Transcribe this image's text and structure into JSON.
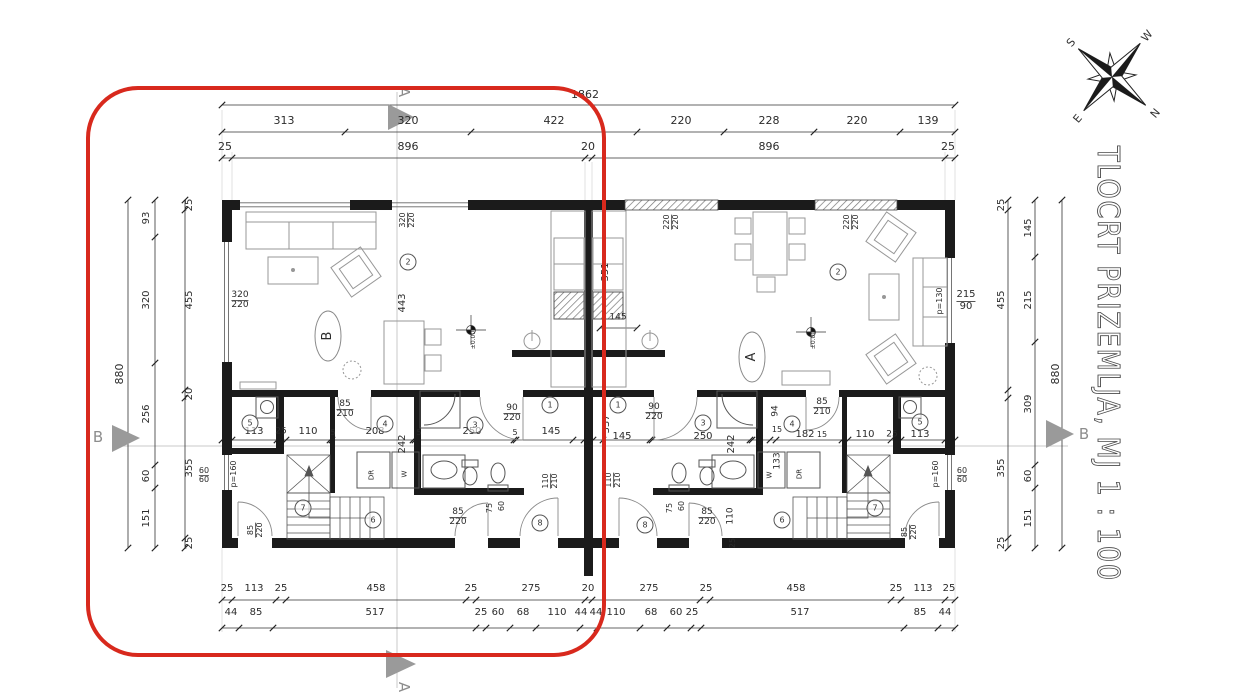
{
  "title": {
    "text": "TLOCRT PRIZEMLJA, MJ 1 : 100"
  },
  "compass": {
    "s": "S",
    "w": "W",
    "e": "E",
    "n": "N"
  },
  "section_markers": {
    "top": "A",
    "bottom": "A",
    "left": "B",
    "right": "B"
  },
  "units": {
    "left_oval_label": "B",
    "right_oval_label": "A"
  },
  "highlight_color": "#d8291d",
  "dimension_chains": {
    "top": {
      "total": "1862",
      "mid": [
        "313",
        "320",
        "422",
        "220",
        "228",
        "220",
        "139"
      ],
      "inner": [
        "25",
        "896",
        "20",
        "896",
        "25"
      ]
    },
    "left": {
      "total": "880",
      "mid": [
        "93",
        "320",
        "256",
        "60",
        "151"
      ],
      "inner": [
        "25",
        "455",
        "20",
        "355",
        "25"
      ]
    },
    "right": {
      "total": "880",
      "mid": [
        "145",
        "215",
        "309",
        "60",
        "151"
      ],
      "inner": [
        "25",
        "455",
        "355",
        "25"
      ]
    },
    "bottom": {
      "outer": [
        "25",
        "113",
        "25",
        "458",
        "25",
        "275",
        "20",
        "275",
        "25",
        "458",
        "25",
        "113",
        "25"
      ],
      "inner": [
        "44",
        "85",
        "517",
        "25",
        "60",
        "68",
        "110",
        "44",
        "44",
        "110",
        "68",
        "60",
        "25",
        "517",
        "85",
        "44"
      ]
    }
  },
  "room_numbers": [
    [
      408,
      262,
      "2"
    ],
    [
      550,
      405,
      "1"
    ],
    [
      475,
      425,
      "3"
    ],
    [
      385,
      424,
      "4"
    ],
    [
      250,
      423,
      "5"
    ],
    [
      373,
      520,
      "6"
    ],
    [
      303,
      508,
      "7"
    ],
    [
      540,
      523,
      "8"
    ],
    [
      838,
      272,
      "2"
    ],
    [
      618,
      405,
      "1"
    ],
    [
      703,
      423,
      "3"
    ],
    [
      792,
      424,
      "4"
    ],
    [
      920,
      422,
      "5"
    ],
    [
      782,
      520,
      "6"
    ],
    [
      875,
      508,
      "7"
    ],
    [
      645,
      525,
      "8"
    ]
  ],
  "plan_labels": [
    [
      585,
      95,
      "1862",
      0,
      11
    ],
    [
      284,
      121,
      "313",
      0,
      11
    ],
    [
      408,
      121,
      "320",
      0,
      11
    ],
    [
      554,
      121,
      "422",
      0,
      11
    ],
    [
      681,
      121,
      "220",
      0,
      11
    ],
    [
      769,
      121,
      "228",
      0,
      11
    ],
    [
      857,
      121,
      "220",
      0,
      11
    ],
    [
      928,
      121,
      "139",
      0,
      11
    ],
    [
      225,
      147,
      "25",
      0,
      11
    ],
    [
      408,
      147,
      "896",
      0,
      11
    ],
    [
      588,
      147,
      "20",
      0,
      11
    ],
    [
      769,
      147,
      "896",
      0,
      11
    ],
    [
      948,
      147,
      "25",
      0,
      11
    ],
    [
      227,
      589,
      "25",
      0,
      10
    ],
    [
      254,
      589,
      "113",
      0,
      10
    ],
    [
      281,
      589,
      "25",
      0,
      10
    ],
    [
      376,
      589,
      "458",
      0,
      10
    ],
    [
      471,
      589,
      "25",
      0,
      10
    ],
    [
      531,
      589,
      "275",
      0,
      10
    ],
    [
      588,
      589,
      "20",
      0,
      10
    ],
    [
      649,
      589,
      "275",
      0,
      10
    ],
    [
      706,
      589,
      "25",
      0,
      10
    ],
    [
      796,
      589,
      "458",
      0,
      10
    ],
    [
      896,
      589,
      "25",
      0,
      10
    ],
    [
      923,
      589,
      "113",
      0,
      10
    ],
    [
      949,
      589,
      "25",
      0,
      10
    ],
    [
      231,
      613,
      "44",
      0,
      10
    ],
    [
      256,
      613,
      "85",
      0,
      10
    ],
    [
      375,
      613,
      "517",
      0,
      10
    ],
    [
      481,
      613,
      "25",
      0,
      10
    ],
    [
      498,
      613,
      "60",
      0,
      10
    ],
    [
      523,
      613,
      "68",
      0,
      10
    ],
    [
      557,
      613,
      "110",
      0,
      10
    ],
    [
      581,
      613,
      "44",
      0,
      10
    ],
    [
      596,
      613,
      "44",
      0,
      10
    ],
    [
      616,
      613,
      "110",
      0,
      10
    ],
    [
      651,
      613,
      "68",
      0,
      10
    ],
    [
      676,
      613,
      "60",
      0,
      10
    ],
    [
      692,
      613,
      "25",
      0,
      10
    ],
    [
      800,
      613,
      "517",
      0,
      10
    ],
    [
      920,
      613,
      "85",
      0,
      10
    ],
    [
      945,
      613,
      "44",
      0,
      10
    ],
    [
      120,
      374,
      "880",
      -90,
      11
    ],
    [
      147,
      218,
      "93",
      -90,
      10
    ],
    [
      147,
      300,
      "320",
      -90,
      10
    ],
    [
      147,
      414,
      "256",
      -90,
      10
    ],
    [
      147,
      476,
      "60",
      -90,
      10
    ],
    [
      147,
      518,
      "151",
      -90,
      10
    ],
    [
      190,
      205,
      "25",
      -90,
      10
    ],
    [
      190,
      300,
      "455",
      -90,
      10
    ],
    [
      190,
      394,
      "20",
      -90,
      10
    ],
    [
      190,
      468,
      "355",
      -90,
      10
    ],
    [
      190,
      543,
      "25",
      -90,
      10
    ],
    [
      204,
      476,
      "60|60",
      0,
      8
    ],
    [
      1002,
      205,
      "25",
      -90,
      10
    ],
    [
      1002,
      300,
      "455",
      -90,
      10
    ],
    [
      1002,
      468,
      "355",
      -90,
      10
    ],
    [
      1002,
      543,
      "25",
      -90,
      10
    ],
    [
      1029,
      228,
      "145",
      -90,
      10
    ],
    [
      1029,
      300,
      "215",
      -90,
      10
    ],
    [
      1029,
      404,
      "309",
      -90,
      10
    ],
    [
      1029,
      476,
      "60",
      -90,
      10
    ],
    [
      1029,
      518,
      "151",
      -90,
      10
    ],
    [
      1056,
      374,
      "880",
      -90,
      11
    ],
    [
      962,
      476,
      "60|60",
      0,
      8
    ],
    [
      966,
      301,
      "215|90",
      0,
      10
    ],
    [
      940,
      301,
      "p=130",
      -90,
      8
    ],
    [
      936,
      474,
      "p=160",
      -90,
      8
    ],
    [
      240,
      301,
      "320|220",
      0,
      9
    ],
    [
      408,
      220,
      "320|220",
      -90,
      8
    ],
    [
      403,
      303,
      "443",
      -90,
      10
    ],
    [
      474,
      340,
      "±0.00",
      -90,
      6
    ],
    [
      345,
      410,
      "85|210",
      0,
      9
    ],
    [
      512,
      414,
      "90|220",
      0,
      9
    ],
    [
      254,
      432,
      "113",
      0,
      10
    ],
    [
      281,
      432,
      "25",
      0,
      9
    ],
    [
      308,
      432,
      "110",
      0,
      10
    ],
    [
      333,
      433,
      "5",
      0,
      8
    ],
    [
      375,
      432,
      "208",
      0,
      10
    ],
    [
      419,
      433,
      "5",
      0,
      8
    ],
    [
      472,
      432,
      "250",
      0,
      10
    ],
    [
      515,
      433,
      "5",
      0,
      8
    ],
    [
      551,
      432,
      "145",
      0,
      10
    ],
    [
      403,
      444,
      "242",
      -90,
      10
    ],
    [
      234,
      474,
      "p=160",
      -90,
      8
    ],
    [
      405,
      474,
      "W",
      -90,
      7
    ],
    [
      372,
      475,
      "DR",
      -90,
      7
    ],
    [
      490,
      508,
      "75",
      -90,
      8
    ],
    [
      502,
      506,
      "60",
      -90,
      8
    ],
    [
      458,
      518,
      "85|220",
      0,
      9
    ],
    [
      551,
      481,
      "110|210",
      -90,
      8
    ],
    [
      256,
      530,
      "85|220",
      -90,
      8
    ],
    [
      328,
      336,
      "B",
      -90,
      13
    ],
    [
      672,
      222,
      "220|220",
      -90,
      8
    ],
    [
      852,
      222,
      "220|220",
      -90,
      8
    ],
    [
      606,
      272,
      "351",
      -90,
      10
    ],
    [
      618,
      318,
      "145",
      0,
      9
    ],
    [
      814,
      340,
      "±0.00",
      -90,
      6
    ],
    [
      654,
      413,
      "90|220",
      0,
      9
    ],
    [
      822,
      408,
      "85|210",
      0,
      9
    ],
    [
      607,
      424,
      "337",
      -90,
      10
    ],
    [
      622,
      437,
      "145",
      0,
      10
    ],
    [
      703,
      437,
      "250",
      0,
      10
    ],
    [
      777,
      430,
      "15",
      0,
      8
    ],
    [
      805,
      435,
      "182",
      0,
      10
    ],
    [
      822,
      435,
      "15",
      0,
      8
    ],
    [
      865,
      435,
      "110",
      0,
      10
    ],
    [
      892,
      435,
      "25",
      0,
      9
    ],
    [
      920,
      435,
      "113",
      0,
      10
    ],
    [
      732,
      444,
      "242",
      -90,
      10
    ],
    [
      776,
      411,
      "94",
      -90,
      9
    ],
    [
      778,
      461,
      "133",
      -90,
      9
    ],
    [
      770,
      475,
      "W",
      -90,
      7
    ],
    [
      800,
      474,
      "DR",
      -90,
      7
    ],
    [
      670,
      508,
      "75",
      -90,
      8
    ],
    [
      682,
      506,
      "60",
      -90,
      8
    ],
    [
      707,
      518,
      "85|220",
      0,
      9
    ],
    [
      614,
      480,
      "110|210",
      -90,
      8
    ],
    [
      731,
      516,
      "110",
      -90,
      9
    ],
    [
      733,
      543,
      "25",
      -90,
      8
    ],
    [
      910,
      532,
      "85|220",
      -90,
      8
    ],
    [
      752,
      357,
      "A",
      -90,
      13
    ]
  ]
}
